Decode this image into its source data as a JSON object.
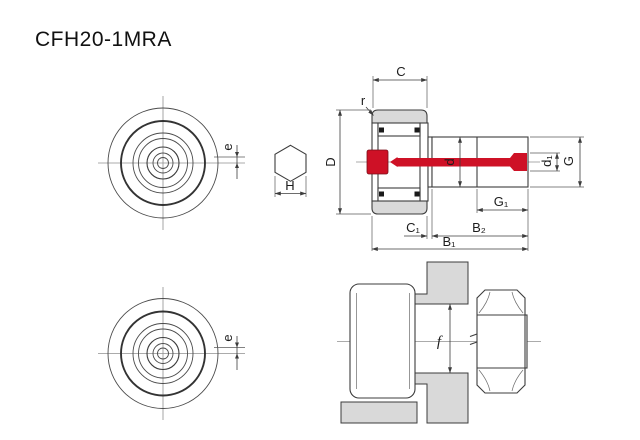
{
  "title": "CFH20-1MRA",
  "colors": {
    "highlight_red": "#ce1126",
    "part_gray": "#d9d9d9",
    "outline": "#3c3c3c"
  },
  "labels": {
    "C": "C",
    "r": "r",
    "D": "D",
    "d": "d",
    "d1": "d₁",
    "G": "G",
    "G1": "G₁",
    "C1": "C₁",
    "B2": "B₂",
    "B1": "B₁",
    "e_top": "e",
    "e_bottom": "e",
    "H": "H",
    "f": "f"
  }
}
